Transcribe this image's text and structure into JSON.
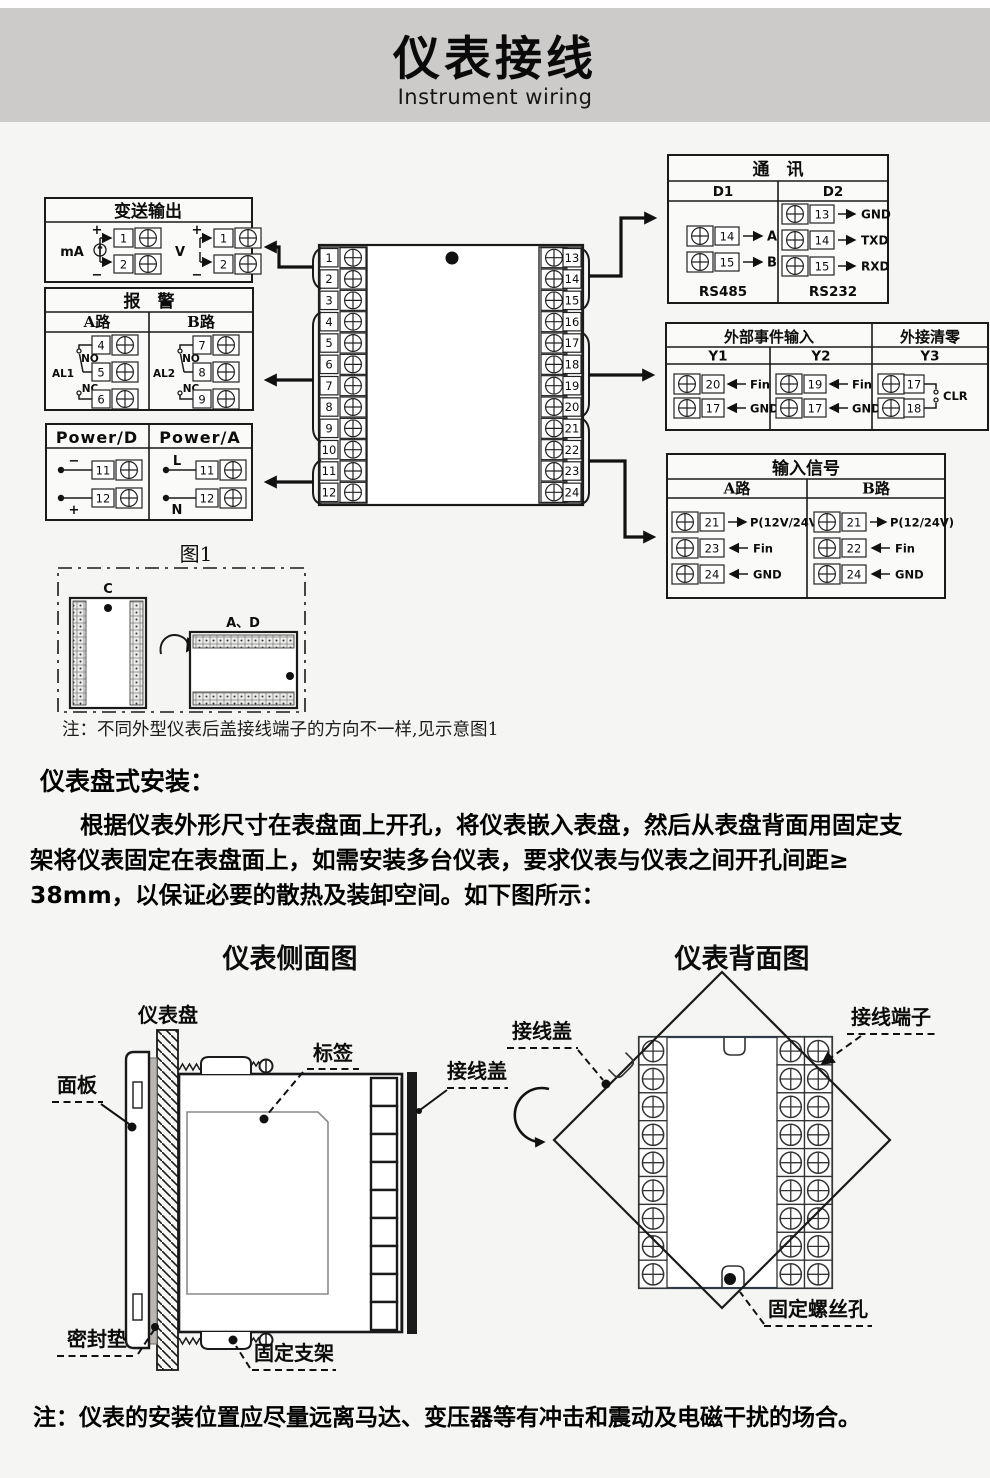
{
  "header": {
    "title": "仪表接线",
    "subtitle": "Instrument wiring"
  },
  "wiring": {
    "transmitter": {
      "title": "变送输出",
      "ma": "mA",
      "v": "V",
      "plus": "+",
      "minus": "−",
      "t1": "1",
      "t2": "2"
    },
    "alarm": {
      "title": "报　警",
      "a": "A路",
      "b": "B路",
      "al1": "AL1",
      "al2": "AL2",
      "no": "NO",
      "nc": "NC",
      "t4": "4",
      "t5": "5",
      "t6": "6",
      "t7": "7",
      "t8": "8",
      "t9": "9"
    },
    "power": {
      "d": "Power/D",
      "a": "Power/A",
      "plus": "+",
      "minus": "−",
      "l": "L",
      "n": "N",
      "t11": "11",
      "t12": "12"
    },
    "center": {
      "left": [
        "1",
        "2",
        "3",
        "4",
        "5",
        "6",
        "7",
        "8",
        "9",
        "10",
        "11",
        "12"
      ],
      "right": [
        "13",
        "14",
        "15",
        "16",
        "17",
        "18",
        "19",
        "20",
        "21",
        "22",
        "23",
        "24"
      ]
    },
    "comm": {
      "title": "通　讯",
      "d1": "D1",
      "d2": "D2",
      "rs485": "RS485",
      "rs232": "RS232",
      "a": "A",
      "b": "B",
      "gnd": "GND",
      "txd": "TXD",
      "rxd": "RXD",
      "t13": "13",
      "t14": "14",
      "t15": "15"
    },
    "event": {
      "title": "外部事件输入",
      "clear": "外接清零",
      "y1": "Y1",
      "y2": "Y2",
      "y3": "Y3",
      "fin": "Fin",
      "gnd": "GND",
      "clr": "CLR",
      "t17": "17",
      "t18": "18",
      "t19": "19",
      "t20": "20"
    },
    "input": {
      "title": "输入信号",
      "a": "A路",
      "b": "B路",
      "pa": "P(12V/24V)",
      "pb": "P(12/24V)",
      "fin": "Fin",
      "gnd": "GND",
      "t21": "21",
      "t22": "22",
      "t23": "23",
      "t24": "24"
    }
  },
  "figure1": {
    "caption": "图1",
    "c": "C",
    "ad": "A、D",
    "note": "注：不同外型仪表后盖接线端子的方向不一样,见示意图1"
  },
  "install": {
    "heading": "仪表盘式安装：",
    "lines": [
      "根据仪表外形尺寸在表盘面上开孔，将仪表嵌入表盘，然后从表盘背面用固定支",
      "架将仪表固定在表盘面上，如需安装多台仪表，要求仪表与仪表之间开孔间距≥",
      "38mm，以保证必要的散热及装卸空间。如下图所示："
    ]
  },
  "side_view": {
    "title": "仪表侧面图",
    "panel": "仪表盘",
    "face": "面板",
    "tag": "标签",
    "cover": "接线盖",
    "gasket": "密封垫",
    "bracket": "固定支架"
  },
  "back_view": {
    "title": "仪表背面图",
    "cover": "接线盖",
    "terminal": "接线端子",
    "hole": "固定螺丝孔"
  },
  "footer": {
    "note": "注：仪表的安装位置应尽量远离马达、变压器等有冲击和震动及电磁干扰的场合。"
  },
  "colors": {
    "band": "#cccbca",
    "page_bg": "#f5f5f3",
    "line": "#1a1a1a"
  }
}
